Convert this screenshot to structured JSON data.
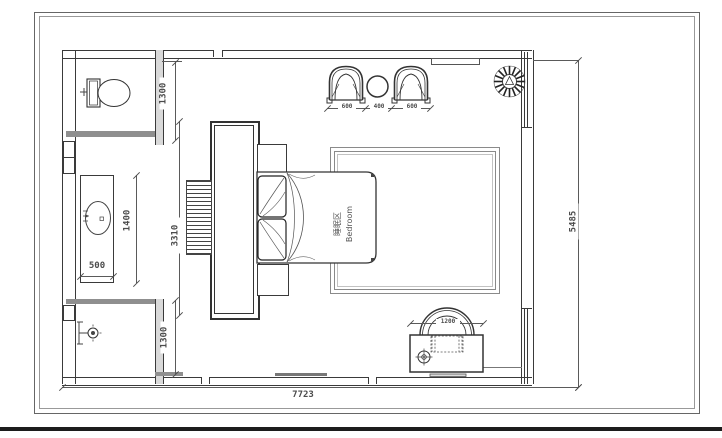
{
  "sheet": {
    "type": "floor-plan-drawing"
  },
  "room": {
    "label_zh": "睡眠区",
    "label_en": "Bedroom"
  },
  "dims": {
    "toilet_depth": "1300",
    "vanity_length": "1400",
    "vanity_width": "500",
    "cabinet_length": "3310",
    "shower_depth": "1300",
    "chair_left": "600",
    "side_table": "400",
    "chair_right": "600",
    "desk_width": "1200",
    "room_depth": "5485",
    "room_width": "7723"
  },
  "colors": {
    "wall_line": "#3a3a3a",
    "dim_text": "#4c4c4c",
    "wall_dark_fill": "#8f8f8f",
    "partition_fill": "#d9d9d9",
    "sheet_bar": "#1c1c1c"
  }
}
